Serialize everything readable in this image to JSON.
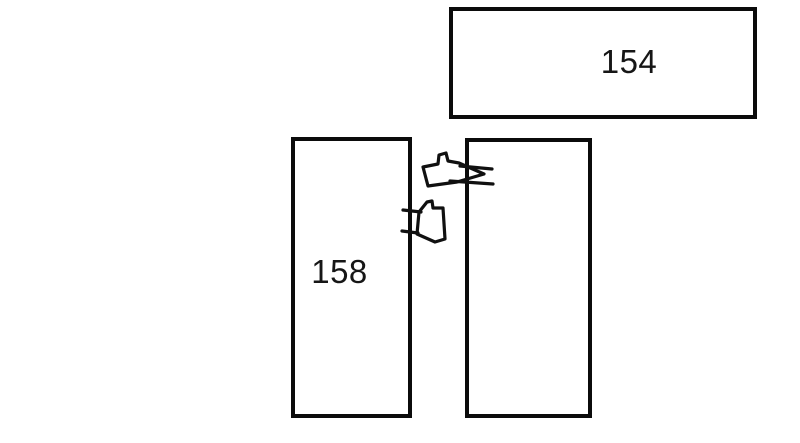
{
  "diagram": {
    "boxes": {
      "top": {
        "label": "154"
      },
      "left": {
        "label": "158"
      },
      "right": {
        "label": ""
      }
    },
    "icons": {
      "arrow_top": "hand-drawn-arrow-right-icon",
      "arrow_bottom": "hand-drawn-arrow-left-icon"
    },
    "colors": {
      "background": "#ffffff",
      "ink": "#0b0b0b",
      "label_text": "#161616"
    }
  }
}
